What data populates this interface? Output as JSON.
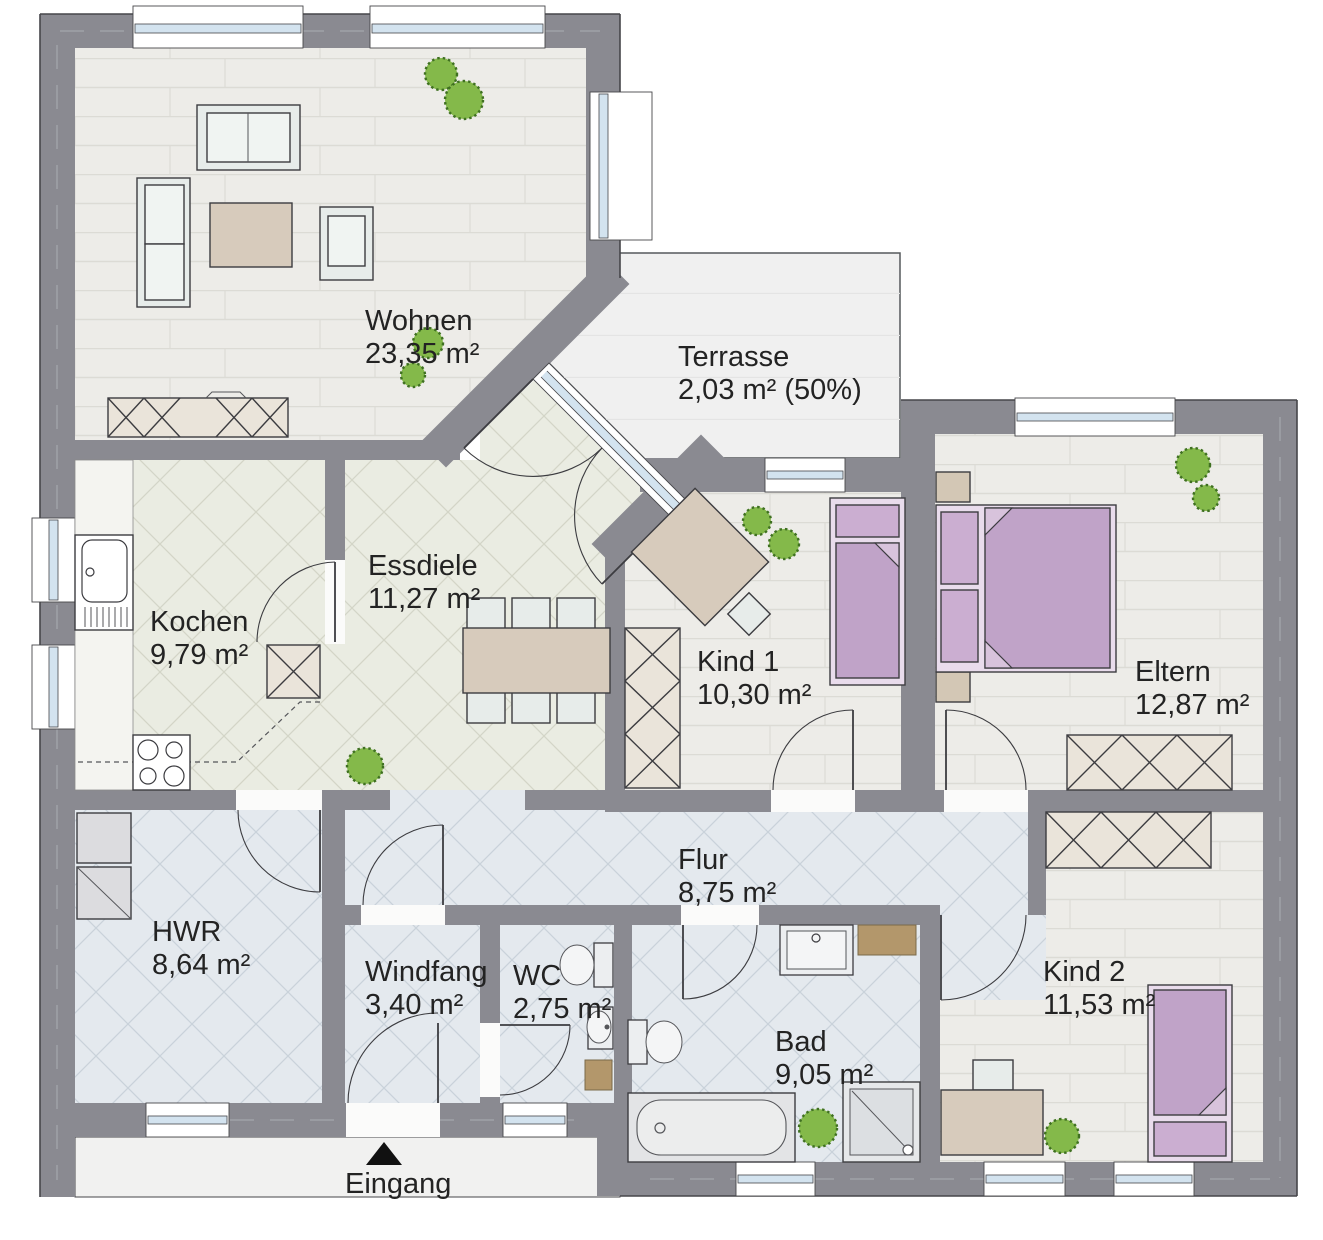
{
  "plan": {
    "entrance": {
      "label": "Eingang"
    },
    "rooms": [
      {
        "id": "wohnen",
        "name": "Wohnen",
        "area": "23,35 m²"
      },
      {
        "id": "terrasse",
        "name": "Terrasse",
        "area": "2,03 m² (50%)"
      },
      {
        "id": "essdiele",
        "name": "Essdiele",
        "area": "11,27 m²"
      },
      {
        "id": "kochen",
        "name": "Kochen",
        "area": "9,79 m²"
      },
      {
        "id": "kind1",
        "name": "Kind 1",
        "area": "10,30 m²"
      },
      {
        "id": "eltern",
        "name": "Eltern",
        "area": "12,87 m²"
      },
      {
        "id": "flur",
        "name": "Flur",
        "area": "8,75 m²"
      },
      {
        "id": "hwr",
        "name": "HWR",
        "area": "8,64 m²"
      },
      {
        "id": "windfang",
        "name": "Windfang",
        "area": "3,40 m²"
      },
      {
        "id": "wc",
        "name": "WC",
        "area": "2,75 m²"
      },
      {
        "id": "bad",
        "name": "Bad",
        "area": "9,05 m²"
      },
      {
        "id": "kind2",
        "name": "Kind 2",
        "area": "11,53 m²"
      }
    ],
    "colors": {
      "wall": "#8a8a91",
      "floor_wood": "#edece8",
      "floor_tile_green": "#eaece2",
      "floor_tile_blue": "#e4e9ee",
      "terrace": "#f0f0f0",
      "bed": "#c0a3c8",
      "bed_frame": "#e9dcec",
      "furniture_beige": "#d7cbbc",
      "wardrobe": "#eae4da",
      "seat": "#e7ecea",
      "plant": "#84b94a",
      "accent_brown": "#b3976b",
      "glass": "#d3e3ef",
      "outline": "#3c3c40"
    }
  }
}
